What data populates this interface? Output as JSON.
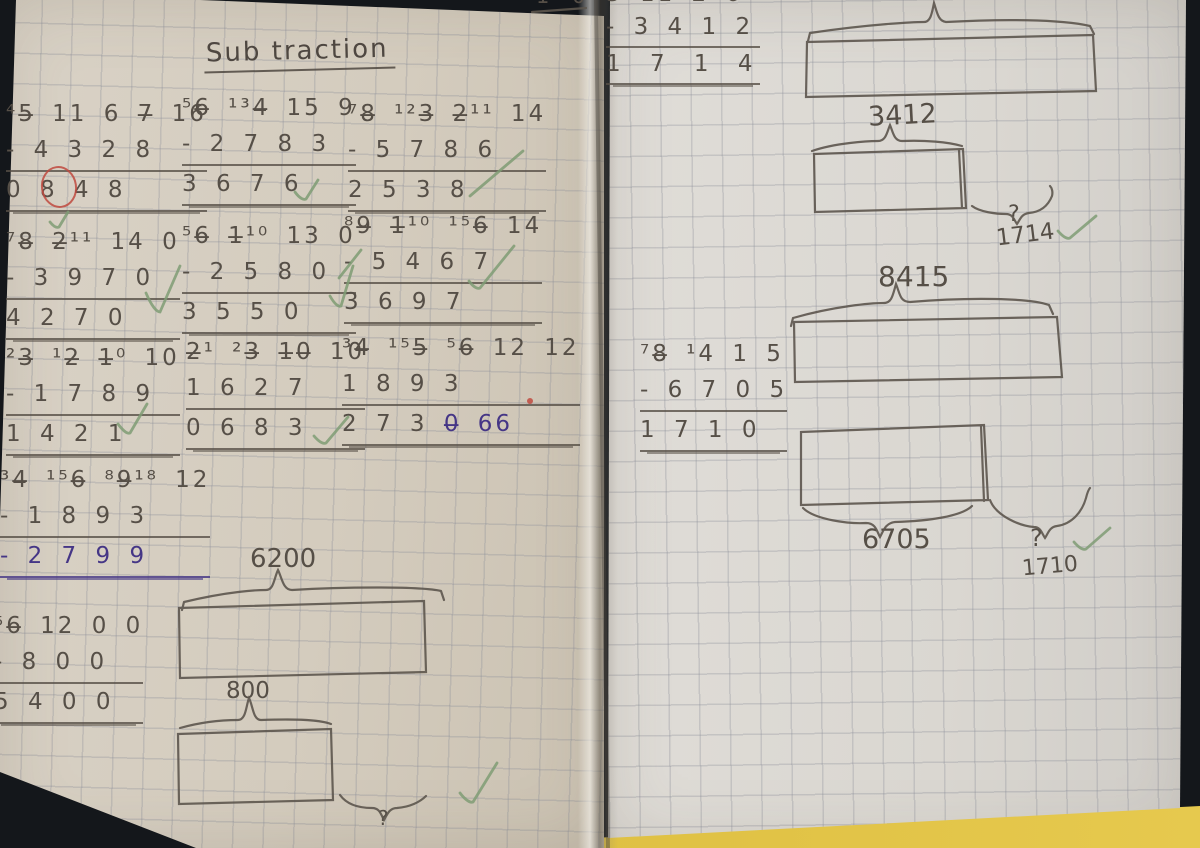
{
  "photo": {
    "background": "#14171b",
    "left_page_color": "#d6cfc3",
    "right_page_color": "#dcd9d3",
    "grid_color": "#8a8d98",
    "pencil_color": "#564f47",
    "purple_color": "#453686",
    "red_color": "#bf4a3f",
    "green_color": "#7f9c74",
    "desk_color": "#e0c24a"
  },
  "title": {
    "text": "Sub traction"
  },
  "left_page": {
    "edge_fragment": "1 0",
    "problems": [
      {
        "top": "⁴5̶ 11 6 7̶ 16",
        "sub": "- 4 3 2 8",
        "res": "0 8 4 8"
      },
      {
        "top": "⁵6̶ ¹³4̶ 15 9",
        "sub": "- 2 7 8 3",
        "res": "3 6 7 6"
      },
      {
        "top": "⁷8̶ ¹²3̶ 2̶¹¹ 14",
        "sub": "- 5 7 8 6",
        "res": "2 5 3 8"
      },
      {
        "top": "⁷8̶ 2̶¹¹ 14 0",
        "sub": "- 3 9 7 0",
        "res": "4 2 7 0"
      },
      {
        "top": "⁵6̶ 1̶¹⁰ 13 0",
        "sub": "- 2 5 8 0",
        "res": "3 5 5 0"
      },
      {
        "top": "⁸9̶ 1̶¹⁰ ¹⁵6̶ 14",
        "sub": "- 5 4 6 7",
        "res": "3 6 9 7"
      },
      {
        "top": "²3̶ ¹2̶ 1̶⁰ 10",
        "sub": "- 1 7 8 9",
        "res": "1 4 2 1"
      },
      {
        "top": "2̶¹ ²3̶ 1̶0̶ 10",
        "sub": "1 6 2 7",
        "res": "0 6 8 3"
      },
      {
        "top": "³4̶ ¹⁵5̶ ⁵6̶ 12 12",
        "sub": "1 8 9 3",
        "res": "2 7 3",
        "res_correction": "0̶ 66"
      },
      {
        "top": "³4̶ ¹⁵6̶ ⁸9̶¹⁸ 12",
        "sub": "- 1 8 9 3",
        "res": "- 2 7 9 9"
      },
      {
        "top": "⁵6̶ 12 0 0",
        "sub": "- 8 0 0",
        "res": "5 4 0 0"
      }
    ],
    "bar_model": {
      "total": "6200",
      "part": "800",
      "unknown": "?"
    }
  },
  "right_page": {
    "problems": [
      {
        "top": "5 11 2 6",
        "sub": "- 3 4 1 2",
        "res": "1 7 1 4"
      },
      {
        "top": "⁷8̶ ¹4 1 5",
        "sub": "- 6 7 0 5",
        "res": "1 7 1 0"
      }
    ],
    "bar_models": [
      {
        "part": "3412",
        "unknown": "?",
        "answer": "1714"
      },
      {
        "total": "8415",
        "part": "6705",
        "unknown": "?",
        "answer": "1710"
      }
    ]
  }
}
